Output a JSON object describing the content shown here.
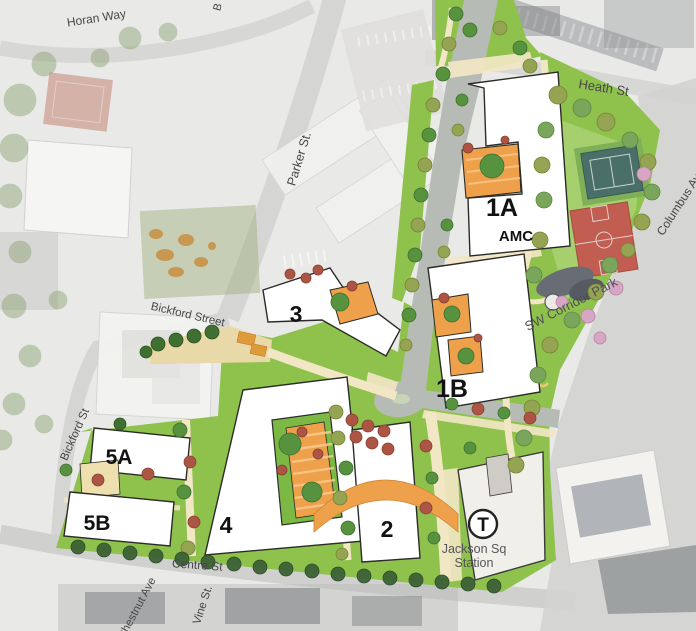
{
  "map": {
    "title": "Jackson Square development site plan",
    "streets": {
      "horan_way": "Horan Way",
      "parker_st": "Parker St.",
      "heath_st": "Heath St",
      "bickford_street": "Bickford Street",
      "bickford_st": "Bickford St",
      "centre_st": "Centre St",
      "chestnut_ave": "Chestnut Ave",
      "vine_st": "Vine St.",
      "columbus_ave": "Columbus Ave",
      "partial_top": "B"
    },
    "parks": {
      "sw_corridor_park": "SW Corridor Park"
    },
    "buildings": {
      "b1a": "1A",
      "amc": "AMC",
      "b1b": "1B",
      "b2": "2",
      "b3": "3",
      "b4": "4",
      "b5a": "5A",
      "b5b": "5B"
    },
    "station": {
      "symbol": "T",
      "line1": "Jackson Sq",
      "line2": "Station"
    },
    "colors": {
      "site_green": "#8fc24d",
      "light_green": "#a8d172",
      "path_cream": "#f2e7c4",
      "shared_street_tan": "#ead9a8",
      "courtyard_orange": "#efa04a",
      "road_gray": "#b7bbb5",
      "court_red": "#c25d52",
      "court_teal": "#4a6e68",
      "tree_green": "#57923f",
      "tree_red": "#ad5544",
      "tree_pink": "#d7a6c4",
      "building_fill": "#ffffff",
      "building_outline": "#2b2b28",
      "station_fill": "#f1efe9"
    }
  }
}
